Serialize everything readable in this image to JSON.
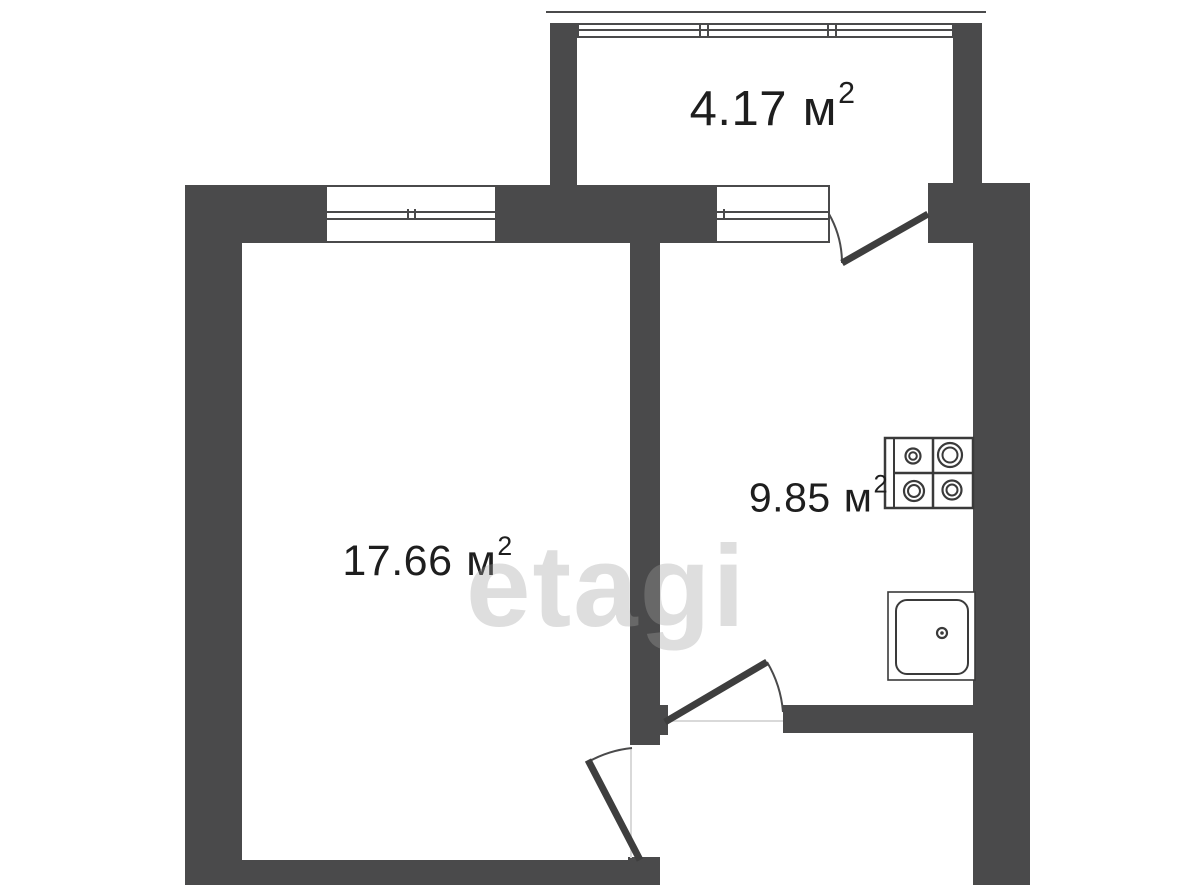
{
  "floor_plan": {
    "watermark": "etagi",
    "colors": {
      "wall": "#4a4a4b",
      "fixture_line": "#3a3a3a",
      "door_leaf": "#3e3e3e",
      "text": "#1e1e1e",
      "background": "#ffffff",
      "watermark": "rgba(160,160,160,0.35)"
    },
    "rooms": [
      {
        "name": "balcony",
        "area": "4.17",
        "unit": "м",
        "sup": "2"
      },
      {
        "name": "living-room",
        "area": "17.66",
        "unit": "м",
        "sup": "2"
      },
      {
        "name": "kitchen",
        "area": "9.85",
        "unit": "м",
        "sup": "2"
      }
    ],
    "fixtures": [
      {
        "name": "stove-icon",
        "burners": 4
      },
      {
        "name": "sink-icon"
      }
    ],
    "openings": {
      "windows": 3,
      "doors": 3
    }
  }
}
